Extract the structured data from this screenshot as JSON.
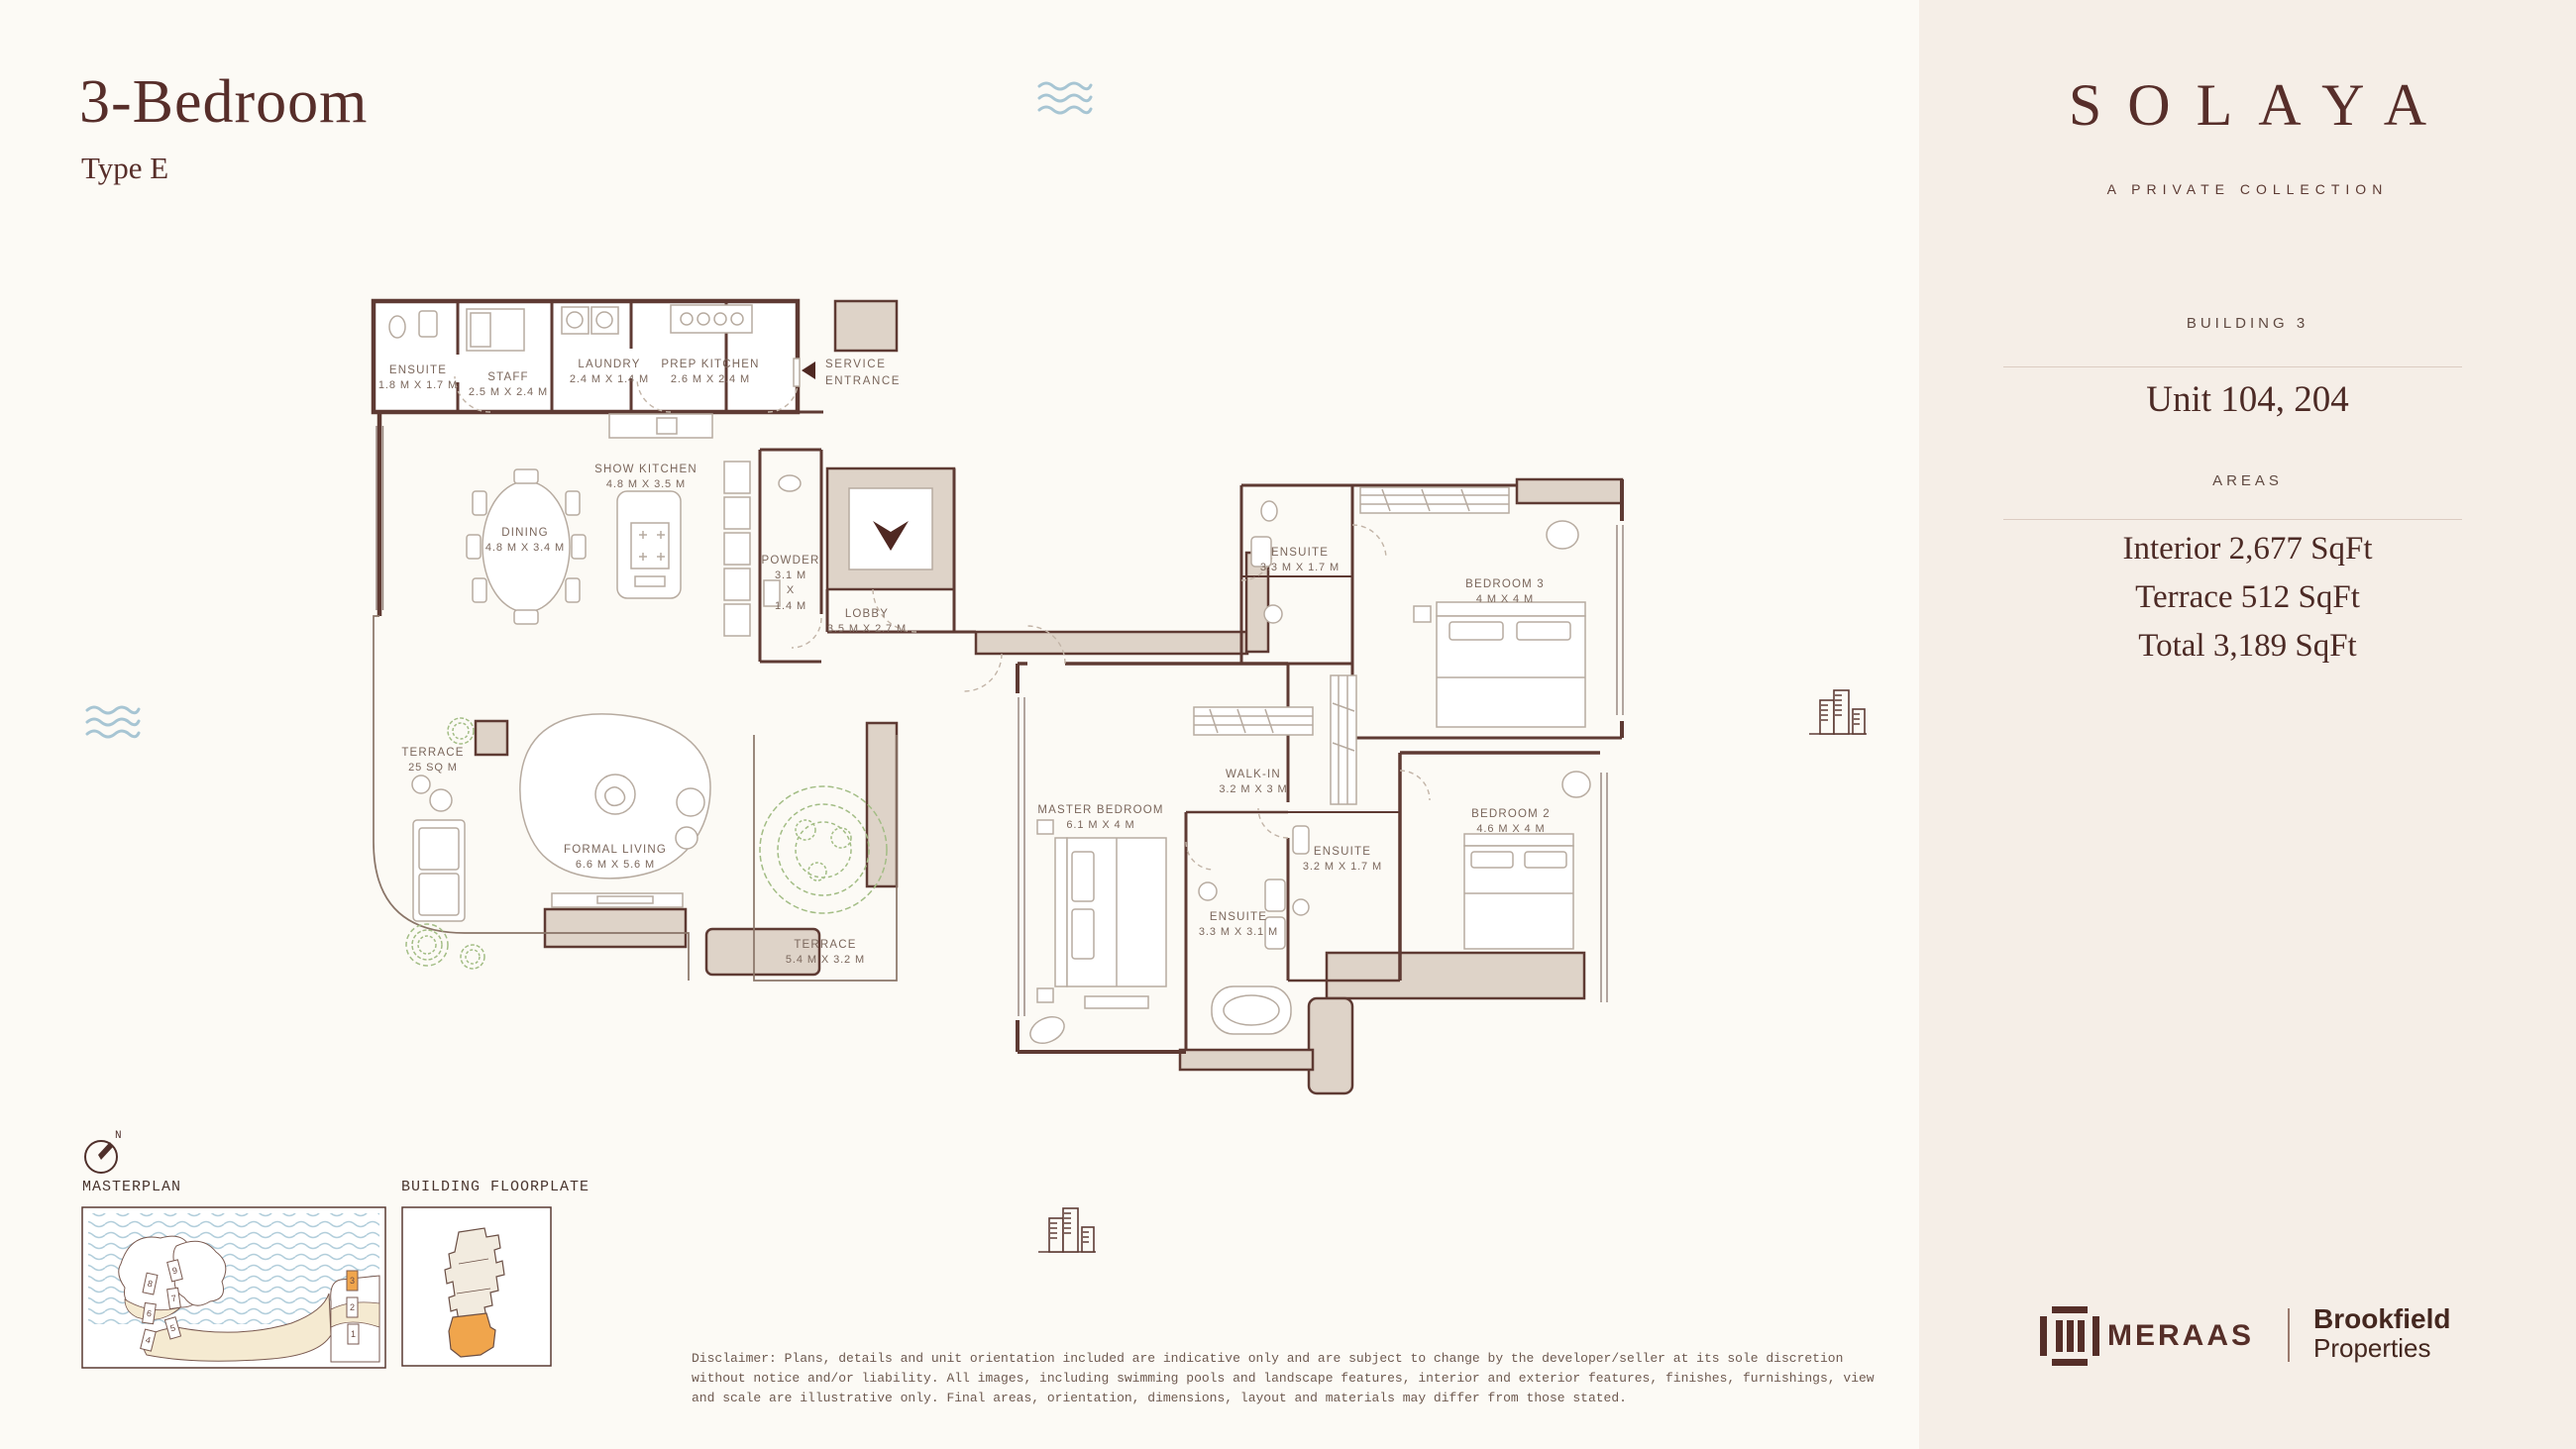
{
  "header": {
    "title": "3-Bedroom",
    "subtitle": "Type E"
  },
  "sidebar": {
    "brand": "SOLAYA",
    "tagline": "A PRIVATE COLLECTION",
    "building_label": "BUILDING 3",
    "unit_label": "Unit 104, 204",
    "areas_label": "AREAS",
    "area_lines": [
      "Interior 2,677 SqFt",
      "Terrace 512 SqFt",
      "Total 3,189 SqFt"
    ],
    "footer": {
      "meraas": "MERAAS",
      "brookfield_line1": "Brookfield",
      "brookfield_line2": "Properties"
    }
  },
  "floorplan": {
    "entrance": {
      "line1": "SERVICE",
      "line2": "ENTRANCE"
    },
    "rooms": [
      {
        "name": "ENSUITE",
        "dims": "1.8 M X 1.7 M"
      },
      {
        "name": "STAFF",
        "dims": "2.5 M X 2.4 M"
      },
      {
        "name": "LAUNDRY",
        "dims": "2.4 M X 1.4 M"
      },
      {
        "name": "PREP KITCHEN",
        "dims": "2.6 M X 2.4 M"
      },
      {
        "name": "SHOW KITCHEN",
        "dims": "4.8 M X 3.5 M"
      },
      {
        "name": "DINING",
        "dims": "4.8 M X 3.4 M"
      },
      {
        "name": "POWDER",
        "dims": "3.1 M X 1.4 M",
        "dims_lines": [
          "3.1 M",
          "X",
          "1.4 M"
        ]
      },
      {
        "name": "LOBBY",
        "dims": "3.5 M X 2.7 M"
      },
      {
        "name": "TERRACE",
        "dims": "25 SQ M"
      },
      {
        "name": "FORMAL LIVING",
        "dims": "6.6 M X 5.6 M"
      },
      {
        "name": "TERRACE",
        "dims": "5.4 M X 3.2 M"
      },
      {
        "name": "MASTER BEDROOM",
        "dims": "6.1 M X 4 M"
      },
      {
        "name": "WALK-IN",
        "dims": "3.2 M X 3 M"
      },
      {
        "name": "ENSUITE",
        "dims": "3.3 M X 3.1 M"
      },
      {
        "name": "ENSUITE",
        "dims": "3.2 M X 1.7 M"
      },
      {
        "name": "BEDROOM 2",
        "dims": "4.6 M X 4 M"
      },
      {
        "name": "ENSUITE",
        "dims": "3.3 M X 1.7 M"
      },
      {
        "name": "BEDROOM 3",
        "dims": "4 M X 4 M"
      }
    ]
  },
  "legend": {
    "north_label": "N",
    "masterplan_label": "MASTERPLAN",
    "floorplate_label": "BUILDING FLOORPLATE",
    "masterplan_buildings": [
      "8",
      "9",
      "6",
      "7",
      "4",
      "5",
      "3",
      "2",
      "1"
    ],
    "highlighted_building": "3"
  },
  "disclaimer": "Disclaimer: Plans, details and unit orientation included are indicative only and are subject to change by the developer/seller at its sole discretion without notice and/or liability. All images, including swimming pools and landscape features, interior and exterior features, finishes, furnishings, view and scale are illustrative only. Final areas, orientation, dimensions, layout and materials may differ from those stated.",
  "colors": {
    "accent_maroon": "#572e2a",
    "wall_line": "#5e3a33",
    "wall_fill": "#ded3c8",
    "highlight_orange": "#f0a54c",
    "water_blue": "#afccda",
    "plant_green": "#a3bd85",
    "sidebar_bg": "#f5eee7",
    "main_bg": "#fcfaf5"
  }
}
